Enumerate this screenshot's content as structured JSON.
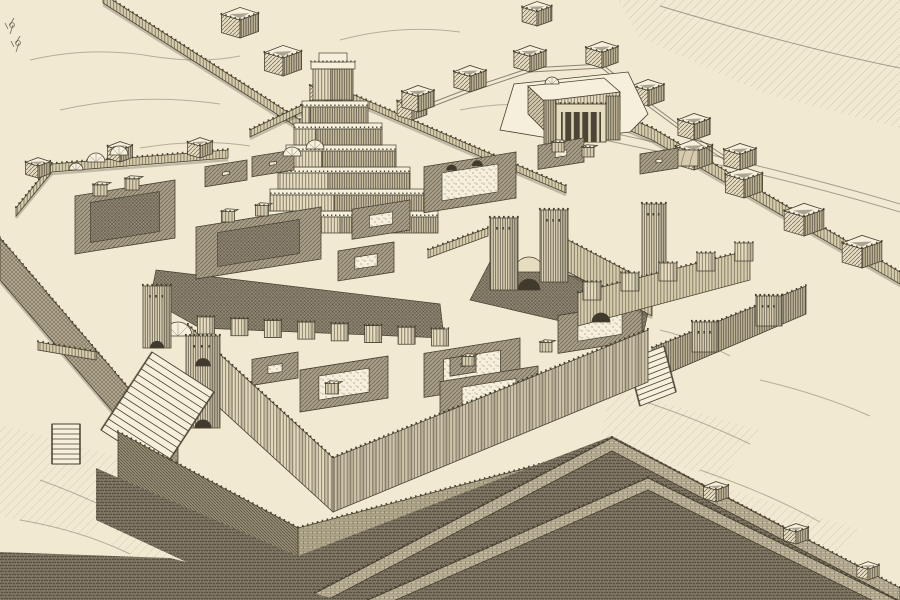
{
  "artwork": {
    "type": "engraving-plate",
    "subject": "bird's-eye reconstruction of an Assyrian palace complex with ziggurat, temple, walled courtyards, gates, staircases and ramparts"
  },
  "palette": {
    "paper": "#f2e9d2",
    "paper_light": "#f6efdc",
    "ink": "#45402f",
    "ink_soft": "#6e6656",
    "wall_light": "#e6dcc0",
    "wall_mid": "#d8cead",
    "wall_dark": "#c4ba9d",
    "shade": "#9a9078",
    "dark_ground": "#7f7663",
    "court_dark": "#8e8572"
  },
  "scene": {
    "walls": {
      "upper_left": {
        "pts": [
          [
            103,
            -6
          ],
          [
            300,
            120
          ]
        ],
        "h": 9,
        "pavilions": [
          [
            240,
            38,
            30
          ],
          [
            283,
            76,
            30
          ],
          [
            326,
            106,
            26
          ]
        ]
      },
      "zig_court": {
        "pts": [
          [
            250,
            130
          ],
          [
            338,
            88
          ],
          [
            470,
            145
          ],
          [
            566,
            186
          ]
        ],
        "h": 7,
        "pavilions": [
          [
            412,
            120,
            24
          ]
        ]
      },
      "right": {
        "pts": [
          [
            600,
            106
          ],
          [
            652,
            128
          ],
          [
            900,
            272
          ]
        ],
        "h": 12,
        "pavilions": [
          [
            694,
            170,
            30
          ],
          [
            744,
            198,
            30
          ],
          [
            804,
            236,
            32
          ],
          [
            862,
            268,
            32
          ]
        ]
      },
      "left_court_north": {
        "pts": [
          [
            16,
            208
          ],
          [
            52,
            164
          ],
          [
            228,
            150
          ]
        ],
        "h": 8,
        "pavilions": [
          [
            38,
            178,
            20
          ],
          [
            120,
            162,
            20
          ],
          [
            200,
            158,
            20
          ]
        ]
      },
      "jetty": {
        "pts": [
          [
            38,
            342
          ],
          [
            96,
            352
          ]
        ],
        "h": 8
      }
    },
    "west_terrace": {
      "pts": [
        [
          0,
          238
        ],
        [
          178,
          446
        ]
      ],
      "h": 42
    },
    "pavilions_top": [
      [
        537,
        26,
        24
      ],
      [
        418,
        112,
        26
      ],
      [
        470,
        92,
        26
      ],
      [
        530,
        72,
        26
      ],
      [
        602,
        68,
        26
      ],
      [
        648,
        106,
        26
      ],
      [
        694,
        140,
        26
      ],
      [
        740,
        170,
        26
      ]
    ],
    "barrel_store": [
      664,
      166,
      34,
      16
    ],
    "ziggurat": {
      "cx": 350,
      "baseW": 176,
      "baseY": 233,
      "tiers": 6,
      "tierH": 22,
      "faceH": 16,
      "shrink": 11,
      "drift": -3,
      "top": [
        311,
        62,
        44,
        38
      ]
    },
    "temple": {
      "podium": [
        [
          500,
          130
        ],
        [
          514,
          84
        ],
        [
          628,
          72
        ],
        [
          648,
          114
        ],
        [
          630,
          132
        ],
        [
          560,
          140
        ]
      ],
      "hall_top": [
        [
          528,
          86
        ],
        [
          604,
          78
        ],
        [
          620,
          92
        ],
        [
          544,
          101
        ]
      ],
      "hall_face": [
        [
          544,
          101
        ],
        [
          620,
          92
        ],
        [
          620,
          120
        ],
        [
          544,
          130
        ]
      ],
      "hall_left": [
        [
          528,
          86
        ],
        [
          544,
          101
        ],
        [
          544,
          130
        ],
        [
          528,
          114
        ]
      ],
      "portico": [
        556,
        104,
        50,
        38
      ],
      "anta_left": [
        544,
        100,
        12,
        44
      ],
      "anta_right": [
        606,
        96,
        14,
        44
      ],
      "dome": [
        552,
        84,
        7
      ]
    },
    "domes": [
      [
        96,
        162,
        9
      ],
      [
        119,
        155,
        9
      ],
      [
        76,
        170,
        7
      ],
      [
        292,
        156,
        9
      ],
      [
        315,
        149,
        9
      ]
    ],
    "courts": [
      [
        75,
        180,
        100,
        58,
        "dark"
      ],
      [
        205,
        160,
        42,
        20,
        ""
      ],
      [
        252,
        150,
        42,
        20,
        ""
      ],
      [
        196,
        207,
        125,
        52,
        "dark"
      ],
      [
        352,
        200,
        58,
        30,
        ""
      ],
      [
        338,
        242,
        56,
        30,
        ""
      ],
      [
        424,
        152,
        92,
        46,
        "niches"
      ],
      [
        538,
        138,
        46,
        24,
        ""
      ],
      [
        640,
        148,
        38,
        20,
        ""
      ],
      [
        558,
        302,
        84,
        38,
        ""
      ],
      [
        252,
        352,
        46,
        26,
        ""
      ],
      [
        300,
        356,
        88,
        42,
        ""
      ],
      [
        424,
        338,
        96,
        44,
        ""
      ],
      [
        440,
        366,
        98,
        40,
        ""
      ],
      [
        450,
        354,
        26,
        18,
        ""
      ]
    ],
    "huts": [
      [
        100,
        196,
        14
      ],
      [
        132,
        190,
        14
      ],
      [
        228,
        222,
        13
      ],
      [
        262,
        216,
        13
      ],
      [
        558,
        152,
        12
      ],
      [
        588,
        157,
        12
      ],
      [
        332,
        394,
        13
      ],
      [
        468,
        366,
        12
      ],
      [
        546,
        352,
        12
      ]
    ],
    "dark_courtyards": [
      [
        [
          156,
          270
        ],
        [
          440,
          304
        ],
        [
          444,
          338
        ],
        [
          200,
          328
        ],
        [
          150,
          300
        ]
      ],
      [
        [
          492,
          258
        ],
        [
          652,
          294
        ],
        [
          642,
          340
        ],
        [
          470,
          300
        ]
      ]
    ],
    "central_gate": {
      "band1": {
        "pts": [
          [
            428,
            250
          ],
          [
            488,
            228
          ]
        ],
        "h": 8
      },
      "tower1": [
        490,
        290,
        28,
        72
      ],
      "arch_x": 529,
      "arch_y": 290,
      "arch_r": 11,
      "tower2": [
        540,
        282,
        28,
        72
      ],
      "band2": {
        "pts": [
          [
            568,
            240
          ],
          [
            652,
            284
          ]
        ],
        "h": 32
      },
      "corner_tower": [
        642,
        292,
        24,
        88
      ]
    },
    "citadel": {
      "wallA": [
        [
          578,
          293
        ],
        [
          750,
          250
        ],
        [
          750,
          280
        ],
        [
          578,
          326
        ]
      ],
      "piersA": [
        [
          592,
          300
        ],
        [
          630,
          291
        ],
        [
          668,
          281
        ],
        [
          706,
          271
        ],
        [
          744,
          261
        ]
      ],
      "archA": [
        601,
        322,
        9
      ],
      "wallB": [
        [
          652,
          348
        ],
        [
          806,
          286
        ],
        [
          806,
          314
        ],
        [
          652,
          380
        ]
      ],
      "bastions": [
        [
          692,
          352,
          26,
          30
        ],
        [
          756,
          326,
          26,
          30
        ]
      ],
      "stair": [
        [
          628,
          360
        ],
        [
          664,
          346
        ],
        [
          676,
          392
        ],
        [
          640,
          406
        ],
        9
      ]
    },
    "palace": {
      "left_face": [
        [
          188,
          325
        ],
        [
          333,
          458
        ],
        [
          333,
          512
        ],
        [
          188,
          379
        ]
      ],
      "right_face": [
        [
          333,
          458
        ],
        [
          648,
          330
        ],
        [
          648,
          382
        ],
        [
          333,
          512
        ]
      ]
    },
    "pier_row": {
      "from": [
        206,
        334
      ],
      "to": [
        440,
        346
      ],
      "n": 8,
      "s": 17
    },
    "left_gate": {
      "tower1": [
        143,
        348,
        28,
        62
      ],
      "tower2": [
        186,
        428,
        34,
        92
      ],
      "dome": [
        178,
        336,
        14
      ]
    },
    "grand_stair": [
      [
        152,
        352
      ],
      [
        214,
        392
      ],
      [
        163,
        470
      ],
      [
        101,
        430
      ],
      14
    ],
    "small_stair": [
      [
        52,
        424
      ],
      [
        80,
        424
      ],
      [
        80,
        464
      ],
      [
        52,
        464
      ],
      8
    ],
    "brick_wall": {
      "left": [
        [
          118,
          432
        ],
        [
          298,
          528
        ],
        [
          298,
          574
        ],
        [
          118,
          478
        ]
      ],
      "right": [
        [
          298,
          528
        ],
        [
          588,
          452
        ],
        [
          588,
          492
        ],
        [
          298,
          570
        ]
      ]
    },
    "moat": [
      [
        96,
        468
      ],
      [
        298,
        556
      ],
      [
        612,
        436
      ],
      [
        900,
        588
      ],
      [
        900,
        600
      ],
      [
        268,
        600
      ],
      [
        96,
        520
      ]
    ],
    "rampart_inner": {
      "pts": [
        [
          306,
          598
        ],
        [
          612,
          438
        ],
        [
          900,
          588
        ]
      ],
      "h": 13,
      "towers": [
        [
          716,
          502,
          20
        ],
        [
          796,
          544,
          20
        ],
        [
          868,
          580,
          18
        ]
      ]
    },
    "rampart_outer": {
      "pts": [
        [
          368,
          600
        ],
        [
          648,
          478
        ],
        [
          896,
          600
        ]
      ],
      "h": 12
    },
    "bottom_left_dark": [
      [
        0,
        552
      ],
      [
        170,
        558
      ],
      [
        340,
        600
      ],
      [
        0,
        600
      ]
    ],
    "hatch_topright": [
      [
        618,
        0
      ],
      [
        900,
        0
      ],
      [
        900,
        128
      ],
      [
        766,
        94
      ],
      [
        640,
        38
      ]
    ],
    "clouds": [
      [
        [
          0,
          424
        ],
        [
          150,
          466
        ],
        [
          92,
          538
        ],
        [
          0,
          516
        ]
      ],
      [
        [
          150,
          480
        ],
        [
          268,
          538
        ],
        [
          210,
          588
        ],
        [
          108,
          544
        ]
      ],
      [
        [
          610,
          388
        ],
        [
          760,
          430
        ],
        [
          720,
          480
        ],
        [
          600,
          440
        ]
      ],
      [
        [
          700,
          480
        ],
        [
          860,
          530
        ],
        [
          820,
          578
        ],
        [
          690,
          540
        ]
      ]
    ],
    "roads": [
      "M660,6 C740,30 820,52 900,68",
      "M608,132 C700,152 800,174 900,204",
      "M604,140 C700,160 800,182 900,212"
    ],
    "sketch_strokes": [
      "M30,60 q60,-14 120,-4 q50,8 90,0",
      "M60,110 q80,-18 160,-6",
      "M140,148 q60,-10 110,-2",
      "M340,40 q60,-16 120,-8",
      "M460,110 q50,-10 90,-2",
      "M40,480 q50,18 90,40 q30,20 60,30",
      "M20,520 q60,10 110,34",
      "M640,400 q60,20 110,44",
      "M700,470 q70,24 120,52",
      "M760,380 q60,14 110,36",
      "M620,560 q80,10 140,24",
      "M80,200 q40,-8 80,-2",
      "M660,330 q40,10 70,26"
    ],
    "trees": [
      [
        10,
        34
      ],
      [
        16,
        52
      ]
    ]
  }
}
